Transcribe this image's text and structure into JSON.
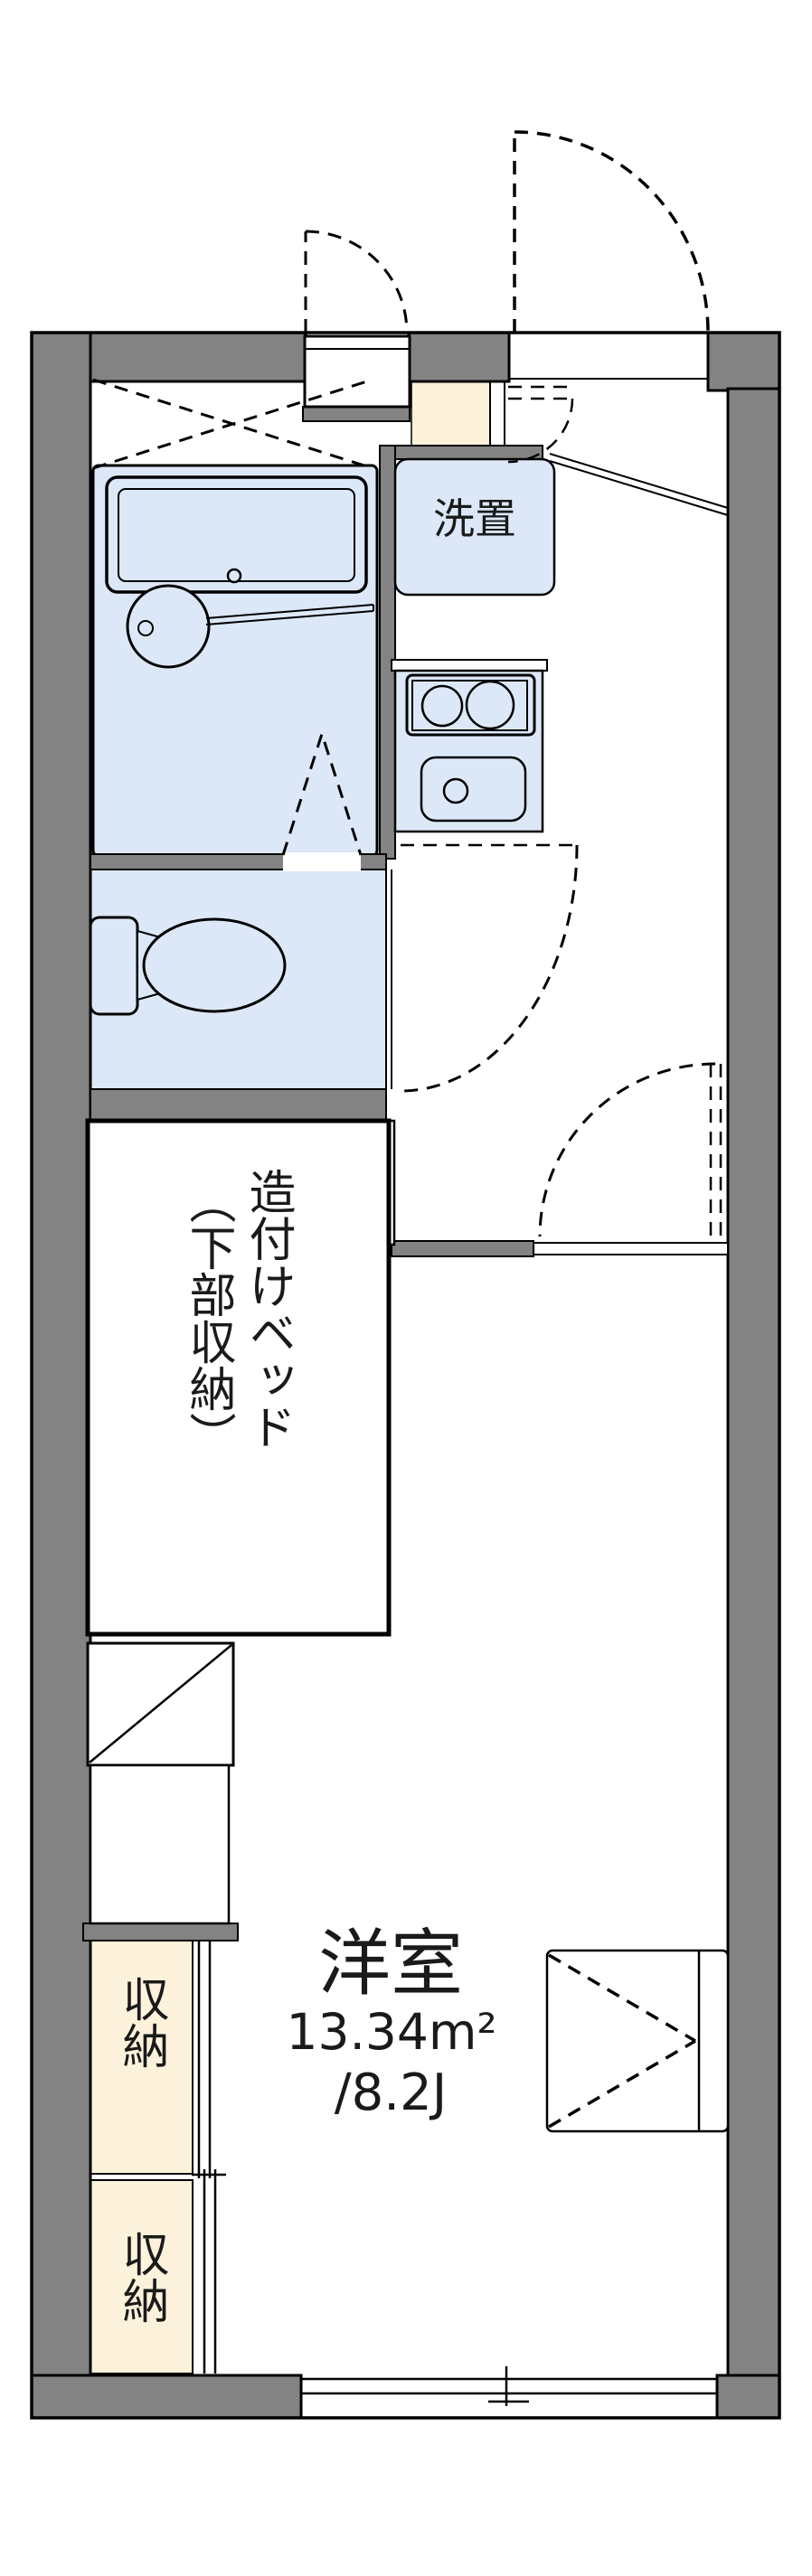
{
  "floorplan": {
    "type": "japanese-apartment-1k-floorplan",
    "labels": {
      "washer_area": "洗置",
      "bed_line1": "造付けベッド",
      "bed_line2": "（下部収納）",
      "storage_upper": "収納",
      "storage_lower": "収納",
      "room_name": "洋室",
      "room_area_m2": "13.34m²",
      "room_area_tatami": "/8.2J"
    },
    "colors": {
      "wall_gray": "#838383",
      "fixture_blue": "#dce8f7",
      "accent_cream": "#fcf2dc",
      "line_black": "#000000",
      "background": "#ffffff"
    }
  }
}
